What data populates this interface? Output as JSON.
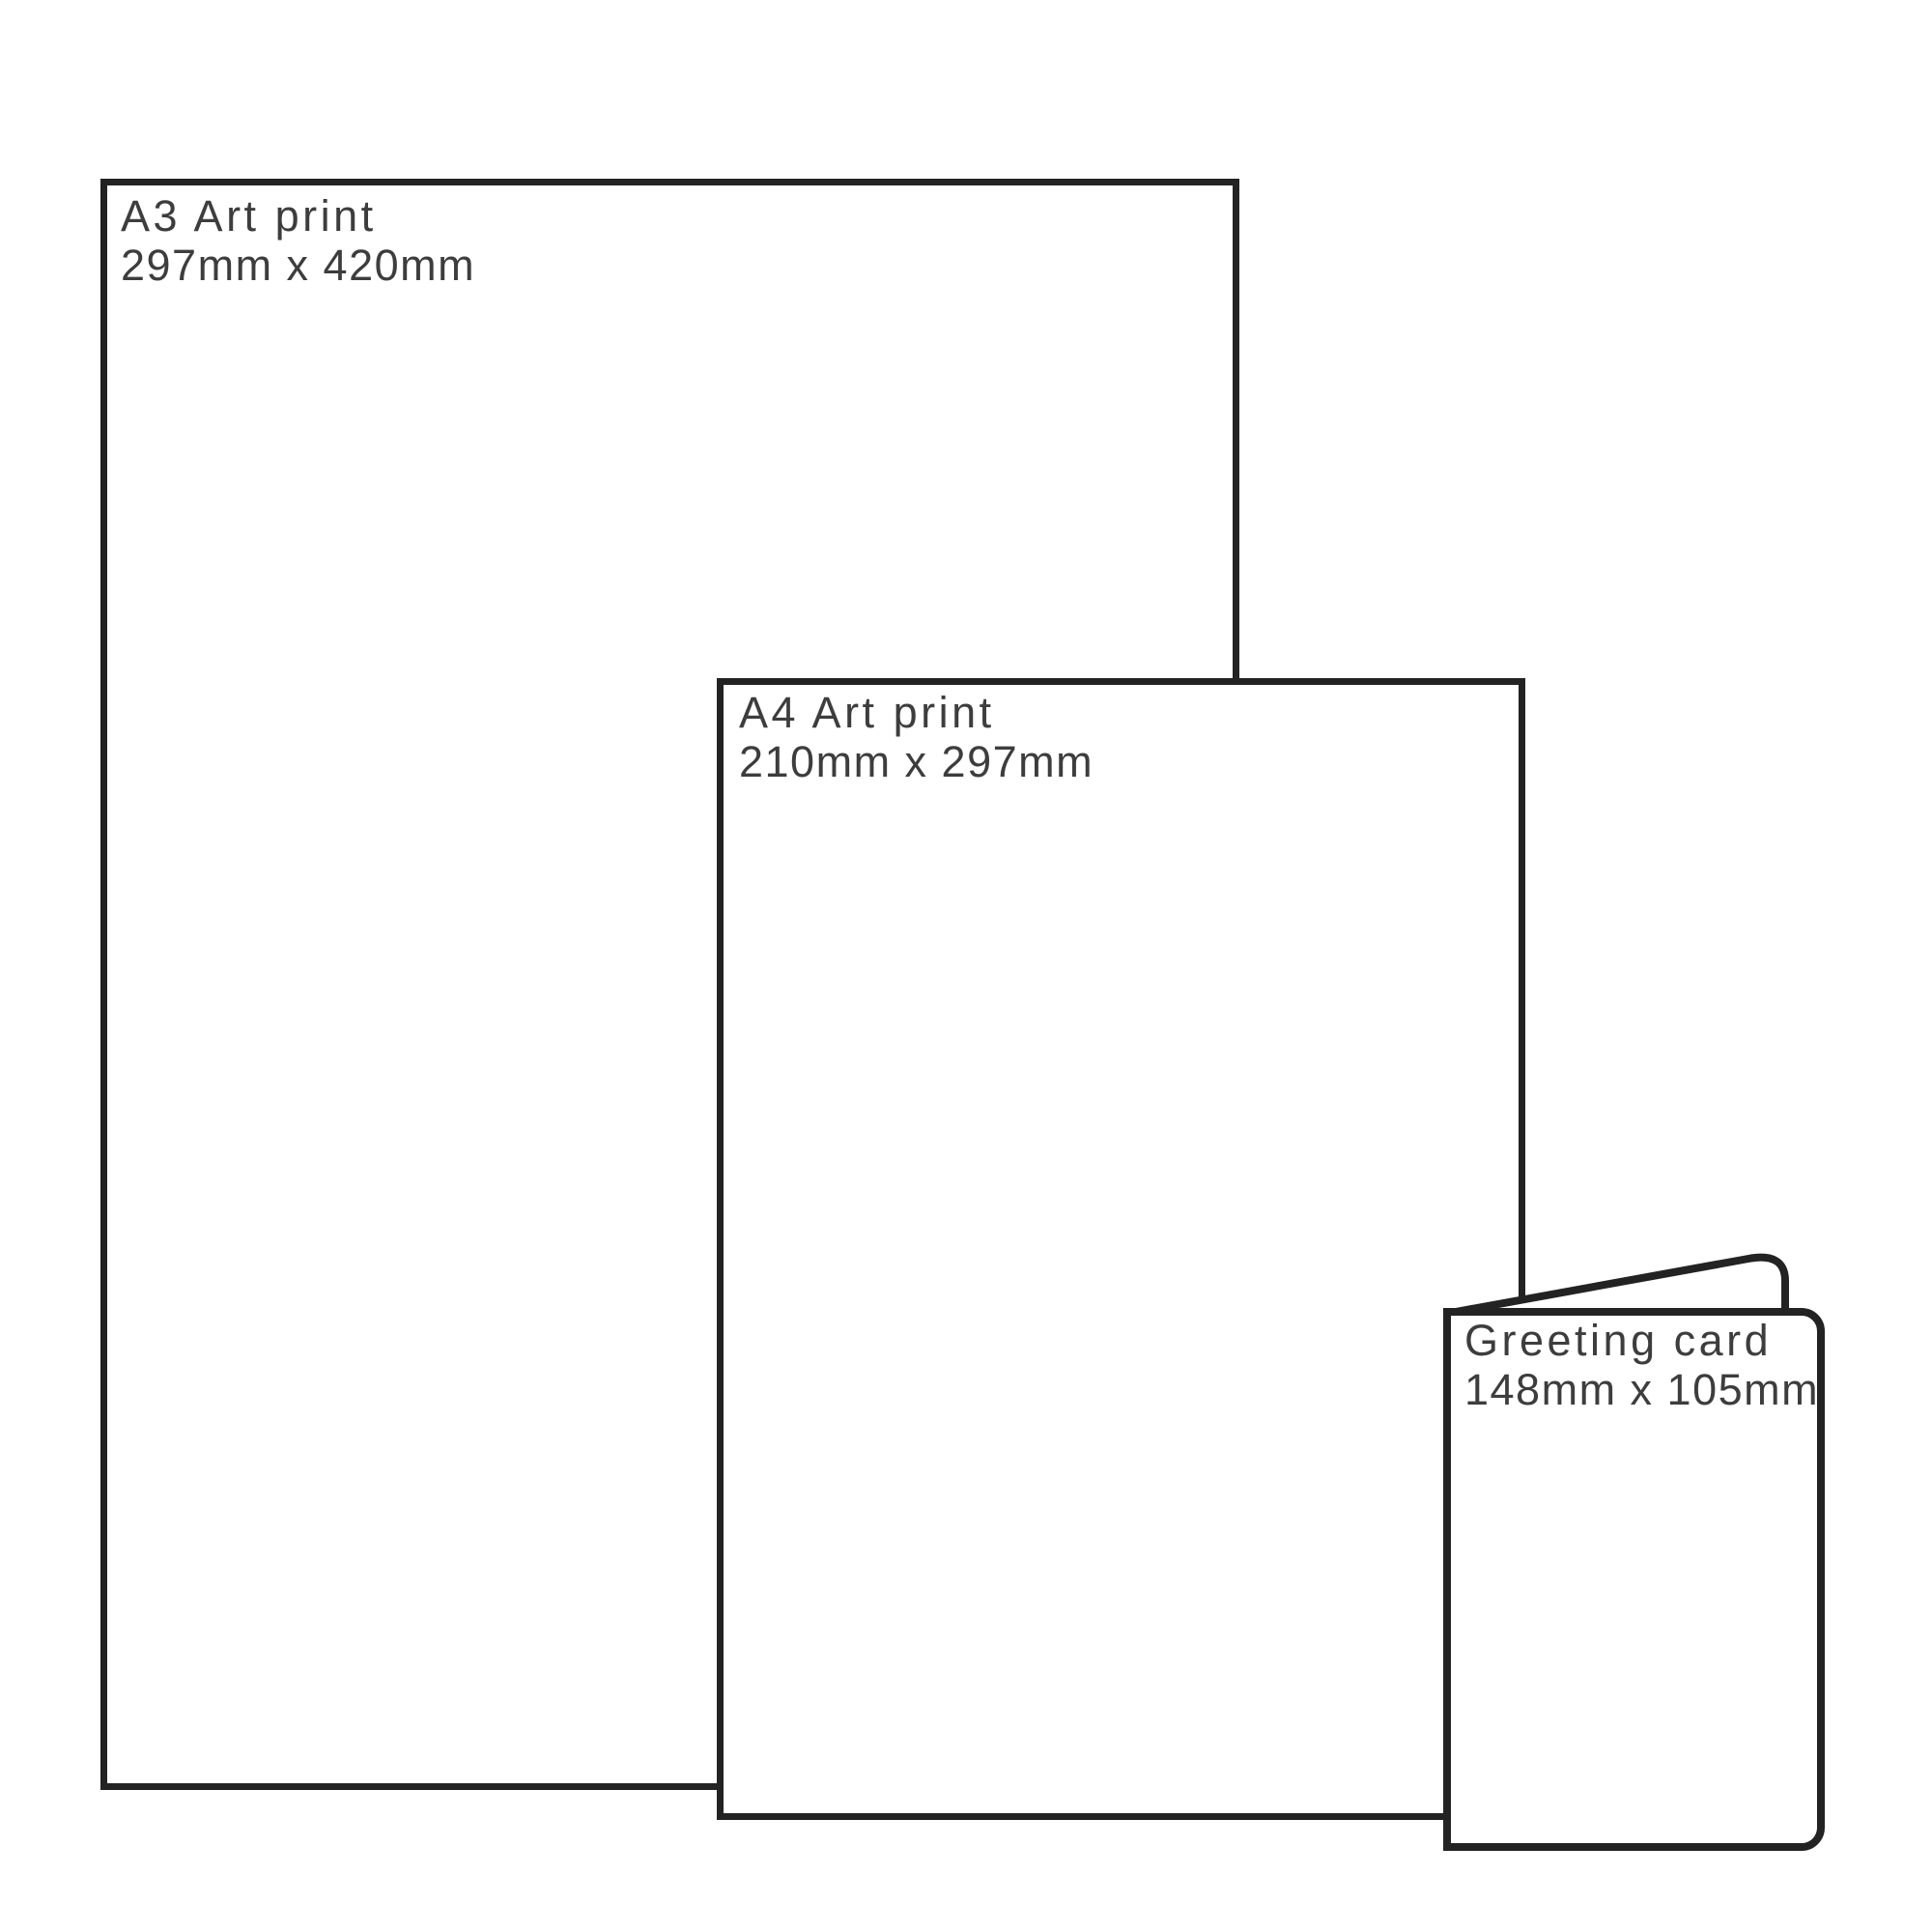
{
  "palette": {
    "background": "#ffffff",
    "outline": "#232323",
    "text": "#3d3d3d"
  },
  "items": [
    {
      "id": "a3-art-print",
      "title": "A3 Art print",
      "dimensions": "297mm x 420mm"
    },
    {
      "id": "a4-art-print",
      "title": "A4 Art print",
      "dimensions": "210mm x 297mm"
    },
    {
      "id": "greeting-card",
      "title": "Greeting card",
      "dimensions": "148mm x 105mm"
    }
  ]
}
